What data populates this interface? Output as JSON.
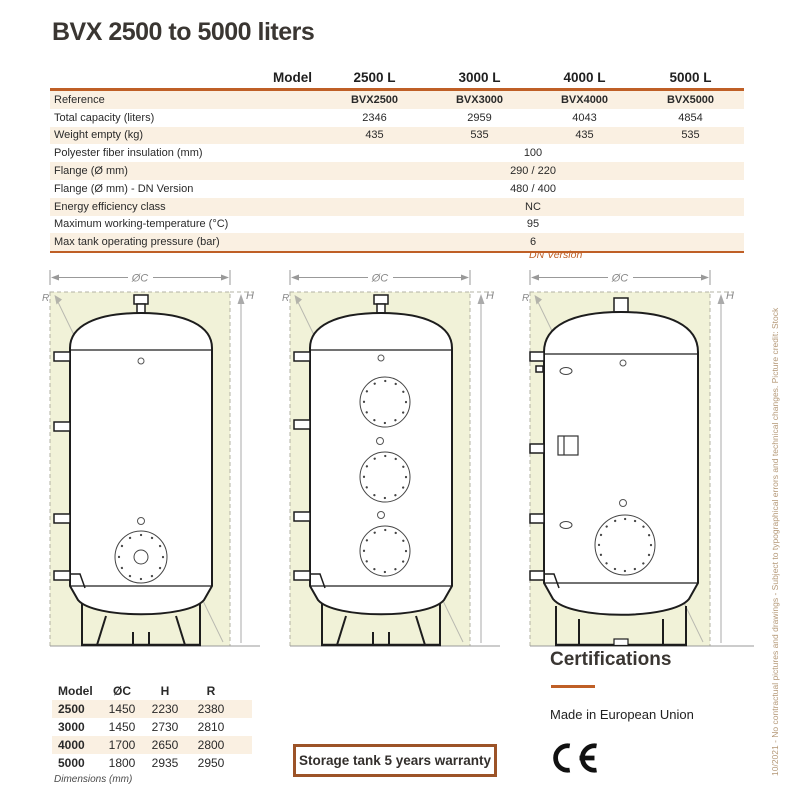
{
  "colors": {
    "accent": "#bf5f26",
    "warranty_border": "#9c5328",
    "stripe": "#faf0e2",
    "diagram_fill": "#f1f2d8",
    "footer_text": "#b49877"
  },
  "title": "BVX 2500 to 5000 liters",
  "spec_table": {
    "header": {
      "label": "Model",
      "columns": [
        "2500 L",
        "3000 L",
        "4000 L",
        "5000 L"
      ]
    },
    "rows": [
      {
        "label": "Reference",
        "values": [
          "BVX2500",
          "BVX3000",
          "BVX4000",
          "BVX5000"
        ],
        "bold_values": true
      },
      {
        "label": "Total capacity (liters)",
        "values": [
          "2346",
          "2959",
          "4043",
          "4854"
        ]
      },
      {
        "label": "Weight empty (kg)",
        "values": [
          "435",
          "535",
          "435",
          "535"
        ]
      },
      {
        "label": "Polyester fiber insulation (mm)",
        "span_value": "100"
      },
      {
        "label": "Flange (Ø mm)",
        "span_value": "290 / 220"
      },
      {
        "label": "Flange (Ø mm) - DN Version",
        "span_value": "480 / 400"
      },
      {
        "label": "Energy efficiency class",
        "span_value": "NC"
      },
      {
        "label": "Maximum working-temperature (°C)",
        "span_value": "95"
      },
      {
        "label": "Max tank operating pressure (bar)",
        "span_value": "6"
      }
    ]
  },
  "dn_version_note": "DN Version",
  "diagrams": {
    "dim_labels": {
      "diameter": "ØC",
      "height": "H",
      "radius": "R"
    }
  },
  "dimensions_table": {
    "headers": [
      "Model",
      "ØC",
      "H",
      "R"
    ],
    "rows": [
      [
        "2500",
        "1450",
        "2230",
        "2380"
      ],
      [
        "3000",
        "1450",
        "2730",
        "2810"
      ],
      [
        "4000",
        "1700",
        "2650",
        "2800"
      ],
      [
        "5000",
        "1800",
        "2935",
        "2950"
      ]
    ],
    "footnote": "Dimensions (mm)"
  },
  "warranty_label": "Storage tank 5 years warranty",
  "certifications": {
    "heading": "Certifications",
    "made_in": "Made in European Union",
    "ce_mark": "CE"
  },
  "footer_note": "10/2021 - No contractual pictures and drawings - Subject to typographical errors and technical changes. Picture credit: Stock"
}
